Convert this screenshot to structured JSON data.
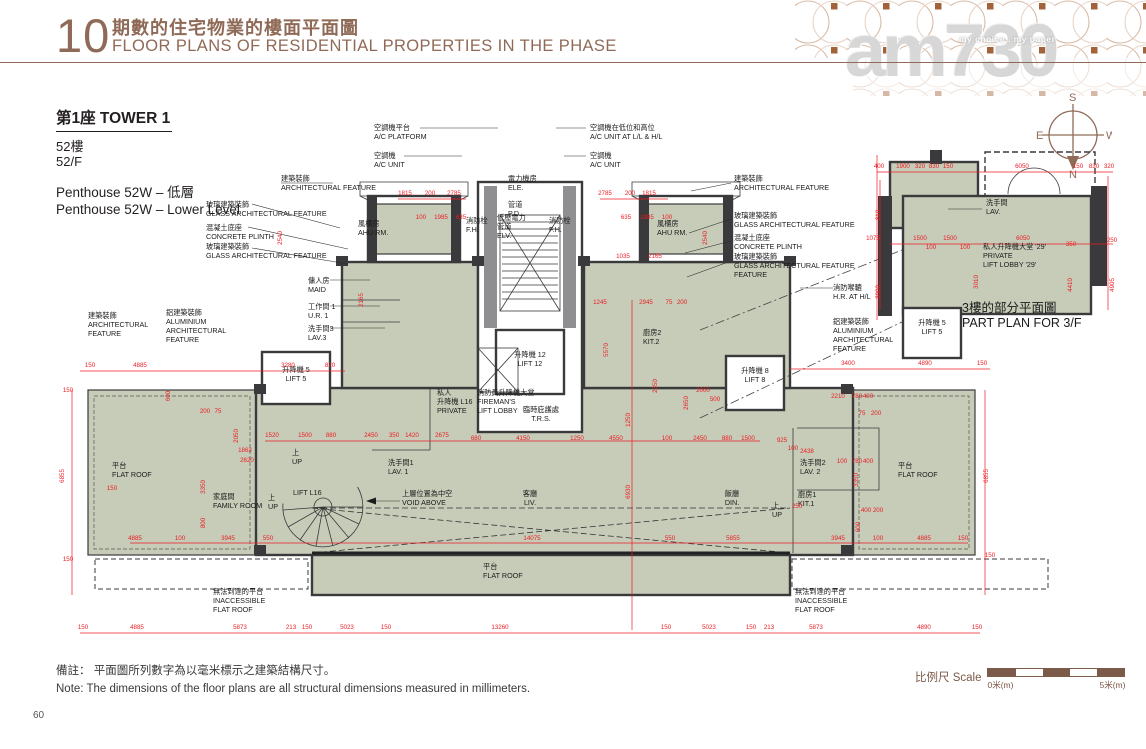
{
  "page": {
    "number": "60"
  },
  "header": {
    "section_number": "10",
    "title_zh": "期數的住宅物業的樓面平面圖",
    "title_en": "FLOOR PLANS OF RESIDENTIAL PROPERTIES IN THE PHASE"
  },
  "watermark": {
    "brand": "am730",
    "tagline": "my choice . my paper"
  },
  "tower": {
    "title": "第1座  TOWER 1",
    "floor_zh": "52樓",
    "floor_en": "52/F",
    "unit_zh": "Penthouse 52W – 低層",
    "unit_en": "Penthouse 52W – Lower Level"
  },
  "compass": {
    "n": "N",
    "s": "S",
    "e": "E",
    "w": "W"
  },
  "notes": {
    "zh": "備註： 平面圖所列數字為以毫米標示之建築結構尺寸。",
    "en": "Note:  The dimensions of the floor plans are all structural dimensions measured in millimeters."
  },
  "scale": {
    "label": "比例尺 Scale",
    "start": "0米(m)",
    "end": "5米(m)"
  },
  "plan": {
    "labels": [
      {
        "n": "ac-platform-label",
        "x": 374,
        "y": 130,
        "ls": [
          "空調機平台",
          "A/C PLATFORM"
        ]
      },
      {
        "n": "ac-unit-left-label",
        "x": 374,
        "y": 158,
        "ls": [
          "空調機",
          "A/C UNIT"
        ]
      },
      {
        "n": "ac-unit-llhl-label",
        "x": 590,
        "y": 130,
        "ls": [
          "空調機在低位和高位",
          "A/C UNIT  AT L/L & H/L"
        ]
      },
      {
        "n": "ac-unit-right-label",
        "x": 590,
        "y": 158,
        "ls": [
          "空調機",
          "A/C UNIT"
        ]
      },
      {
        "n": "ele-room-label",
        "x": 508,
        "y": 181,
        "ls": [
          "電力機房",
          "ELE."
        ]
      },
      {
        "n": "pipe-duct-label",
        "x": 508,
        "y": 207,
        "ls": [
          "管道",
          "P.D."
        ]
      },
      {
        "n": "fire-hydrant-left-label",
        "x": 466,
        "y": 223,
        "ls": [
          "消防栓",
          "F.H."
        ]
      },
      {
        "n": "elv-duct-label",
        "x": 497,
        "y": 220,
        "ls": [
          "低壓電力",
          "管道",
          "ELV."
        ]
      },
      {
        "n": "fire-hydrant-right-label",
        "x": 549,
        "y": 223,
        "ls": [
          "消防栓",
          "F.H."
        ]
      },
      {
        "n": "ahu-room-left-label",
        "x": 358,
        "y": 226,
        "ls": [
          "風櫃房",
          "AHU RM."
        ]
      },
      {
        "n": "ahu-room-right-label",
        "x": 657,
        "y": 226,
        "ls": [
          "風櫃房",
          "AHU RM."
        ]
      },
      {
        "n": "arch-feature-left-top-label",
        "x": 281,
        "y": 181,
        "ls": [
          "建築裝飾",
          "ARCHITECTURAL FEATURE"
        ]
      },
      {
        "n": "glass-feature-left-label",
        "x": 206,
        "y": 207,
        "ls": [
          "玻璃建築裝飾",
          "GLASS ARCHITECTURAL FEATURE"
        ]
      },
      {
        "n": "concrete-plinth-left-label",
        "x": 206,
        "y": 230,
        "ls": [
          "混凝土底座",
          "CONCRETE PLINTH"
        ]
      },
      {
        "n": "glass-feature-left2-label",
        "x": 206,
        "y": 249,
        "ls": [
          "玻璃建築裝飾",
          "GLASS ARCHITECTURAL FEATURE"
        ]
      },
      {
        "n": "arch-feature-right-top-label",
        "x": 734,
        "y": 181,
        "ls": [
          "建築裝飾",
          "ARCHITECTURAL FEATURE"
        ]
      },
      {
        "n": "glass-feature-right-label",
        "x": 734,
        "y": 218,
        "ls": [
          "玻璃建築裝飾",
          "GLASS ARCHITECTURAL FEATURE"
        ]
      },
      {
        "n": "concrete-plinth-right-label",
        "x": 734,
        "y": 240,
        "ls": [
          "混凝土底座",
          "CONCRETE PLINTH"
        ]
      },
      {
        "n": "glass-feature-right2-label",
        "x": 734,
        "y": 259,
        "ls": [
          "玻璃建築裝飾",
          "GLASS ARCHITECTURAL FEATURE",
          "FEATURE"
        ]
      },
      {
        "n": "maid-room-label",
        "x": 308,
        "y": 283,
        "ls": [
          "傭人房",
          "MAID"
        ]
      },
      {
        "n": "utility-room-1-label",
        "x": 308,
        "y": 309,
        "ls": [
          "工作間 1",
          "U.R. 1"
        ]
      },
      {
        "n": "lavatory-3-label",
        "x": 308,
        "y": 331,
        "ls": [
          "洗手間3",
          "LAV.3"
        ]
      },
      {
        "n": "arch-feature-left-mid-label",
        "x": 88,
        "y": 318,
        "ls": [
          "建築裝飾",
          "ARCHITECTURAL",
          "FEATURE"
        ]
      },
      {
        "n": "aluminium-feature-left-label",
        "x": 166,
        "y": 315,
        "ls": [
          "鋁建築裝飾",
          "ALUMINIUM",
          "ARCHITECTURAL",
          "FEATURE"
        ]
      },
      {
        "n": "hose-reel-label",
        "x": 833,
        "y": 290,
        "ls": [
          "消防喉轆",
          "H.R. AT H/L"
        ]
      },
      {
        "n": "aluminium-feature-right-label",
        "x": 833,
        "y": 324,
        "ls": [
          "鋁建築裝飾",
          "ALUMINIUM",
          "ARCHITECTURAL",
          "FEATURE"
        ]
      },
      {
        "n": "lift-5-label",
        "x": 296,
        "y": 372,
        "a": "m",
        "ls": [
          "升降機 5",
          "LIFT 5"
        ]
      },
      {
        "n": "lift-12-label",
        "x": 530,
        "y": 357,
        "a": "m",
        "ls": [
          "升降機 12",
          "LIFT 12"
        ]
      },
      {
        "n": "private-lift-l16-label",
        "x": 437,
        "y": 395,
        "ls": [
          "私人",
          "升降機 L16",
          "PRIVATE"
        ]
      },
      {
        "n": "firemans-lift-lobby-label",
        "x": 477,
        "y": 395,
        "ls": [
          "消防員升降機大堂",
          "FIREMAN'S",
          "LIFT LOBBY"
        ]
      },
      {
        "n": "trs-label",
        "x": 541,
        "y": 412,
        "a": "m",
        "ls": [
          "臨時庇護處",
          "T.R.S."
        ]
      },
      {
        "n": "kitchen-2-label",
        "x": 643,
        "y": 335,
        "ls": [
          "廚房2",
          "KIT.2"
        ]
      },
      {
        "n": "lift-8-label",
        "x": 755,
        "y": 373,
        "a": "m",
        "ls": [
          "升降機 8",
          "LIFT 8"
        ]
      },
      {
        "n": "lavatory-1-label",
        "x": 388,
        "y": 465,
        "ls": [
          "洗手間1",
          "LAV. 1"
        ]
      },
      {
        "n": "family-room-label",
        "x": 213,
        "y": 499,
        "ls": [
          "家庭間",
          "FAMILY ROOM"
        ]
      },
      {
        "n": "lift-l16-stair-label",
        "x": 293,
        "y": 495,
        "ls": [
          "LIFT L16"
        ]
      },
      {
        "n": "up-label-1",
        "x": 292,
        "y": 455,
        "ls": [
          "上",
          "UP"
        ]
      },
      {
        "n": "up-label-2",
        "x": 268,
        "y": 500,
        "ls": [
          "上",
          "UP"
        ]
      },
      {
        "n": "up-label-3",
        "x": 772,
        "y": 508,
        "ls": [
          "上",
          "UP"
        ]
      },
      {
        "n": "void-above-label",
        "x": 402,
        "y": 496,
        "ls": [
          "上層位置為中空",
          "VOID ABOVE"
        ]
      },
      {
        "n": "living-room-label",
        "x": 530,
        "y": 496,
        "a": "m",
        "ls": [
          "客廳",
          "LIV."
        ]
      },
      {
        "n": "dining-room-label",
        "x": 732,
        "y": 496,
        "a": "m",
        "ls": [
          "飯廳",
          "DIN."
        ]
      },
      {
        "n": "kitchen-1-label",
        "x": 798,
        "y": 497,
        "ls": [
          "廚房1",
          "KIT.1"
        ]
      },
      {
        "n": "lavatory-2-label",
        "x": 800,
        "y": 465,
        "ls": [
          "洗手間2",
          "LAV. 2"
        ]
      },
      {
        "n": "flat-roof-left-label",
        "x": 112,
        "y": 468,
        "ls": [
          "平台",
          "FLAT ROOF"
        ]
      },
      {
        "n": "flat-roof-right-label",
        "x": 898,
        "y": 468,
        "ls": [
          "平台",
          "FLAT ROOF"
        ]
      },
      {
        "n": "flat-roof-bottom-label",
        "x": 483,
        "y": 569,
        "ls": [
          "平台",
          "FLAT ROOF"
        ]
      },
      {
        "n": "inaccessible-flat-roof-left-label",
        "x": 213,
        "y": 594,
        "ls": [
          "無法到達的平台",
          "INACCESSIBLE",
          "FLAT ROOF"
        ]
      },
      {
        "n": "inaccessible-flat-roof-right-label",
        "x": 795,
        "y": 594,
        "ls": [
          "無法到達的平台",
          "INACCESSIBLE",
          "FLAT ROOF"
        ]
      },
      {
        "n": "part-plan-lav-label",
        "x": 986,
        "y": 205,
        "ls": [
          "洗手間",
          "LAV."
        ]
      },
      {
        "n": "part-plan-lift-lobby-label",
        "x": 983,
        "y": 249,
        "ls": [
          "私人升降機大堂 '29'",
          "PRIVATE",
          "LIFT LOBBY '29'"
        ]
      },
      {
        "n": "part-plan-lift-5-label",
        "x": 932,
        "y": 325,
        "a": "m",
        "ls": [
          "升降機 5",
          "LIFT 5"
        ]
      },
      {
        "n": "part-plan-title",
        "x": 962,
        "y": 312,
        "fs": 12.5,
        "lh": 15,
        "ls": [
          "3樓的部分平面圖",
          "PART PLAN FOR 3/F"
        ]
      }
    ],
    "dims": [
      [
        83,
        629,
        "150"
      ],
      [
        137,
        629,
        "4885"
      ],
      [
        240,
        629,
        "5873"
      ],
      [
        291,
        629,
        "213"
      ],
      [
        307,
        629,
        "150"
      ],
      [
        347,
        629,
        "5023"
      ],
      [
        386,
        629,
        "150"
      ],
      [
        500,
        629,
        "13260"
      ],
      [
        666,
        629,
        "150"
      ],
      [
        709,
        629,
        "5023"
      ],
      [
        751,
        629,
        "150"
      ],
      [
        769,
        629,
        "213"
      ],
      [
        816,
        629,
        "5873"
      ],
      [
        924,
        629,
        "4890"
      ],
      [
        977,
        629,
        "150"
      ],
      [
        135,
        540,
        "4885"
      ],
      [
        180,
        540,
        "100"
      ],
      [
        228,
        540,
        "3945"
      ],
      [
        268,
        540,
        "550"
      ],
      [
        532,
        540,
        "14075"
      ],
      [
        670,
        540,
        "550"
      ],
      [
        733,
        540,
        "5855"
      ],
      [
        838,
        540,
        "3945"
      ],
      [
        878,
        540,
        "100"
      ],
      [
        924,
        540,
        "4885"
      ],
      [
        963,
        540,
        "150"
      ],
      [
        272,
        437,
        "1520"
      ],
      [
        305,
        437,
        "1500"
      ],
      [
        331,
        437,
        "880"
      ],
      [
        371,
        437,
        "2450"
      ],
      [
        394,
        437,
        "350"
      ],
      [
        412,
        437,
        "1420"
      ],
      [
        442,
        437,
        "2675"
      ],
      [
        476,
        440,
        "680"
      ],
      [
        523,
        440,
        "4150"
      ],
      [
        577,
        440,
        "1250"
      ],
      [
        616,
        440,
        "4550"
      ],
      [
        667,
        440,
        "100"
      ],
      [
        700,
        440,
        "2450"
      ],
      [
        727,
        440,
        "880"
      ],
      [
        748,
        440,
        "1500"
      ],
      [
        405,
        195,
        "1815"
      ],
      [
        430,
        195,
        "200"
      ],
      [
        454,
        195,
        "2785"
      ],
      [
        605,
        195,
        "2785"
      ],
      [
        630,
        195,
        "200"
      ],
      [
        649,
        195,
        "1815"
      ],
      [
        421,
        219,
        "100"
      ],
      [
        441,
        219,
        "1985"
      ],
      [
        461,
        219,
        "635"
      ],
      [
        626,
        219,
        "635"
      ],
      [
        647,
        219,
        "1985"
      ],
      [
        667,
        219,
        "100"
      ],
      [
        90,
        367,
        "150"
      ],
      [
        140,
        367,
        "4885"
      ],
      [
        288,
        367,
        "3280"
      ],
      [
        330,
        367,
        "820"
      ],
      [
        848,
        365,
        "3400"
      ],
      [
        925,
        365,
        "4890"
      ],
      [
        982,
        365,
        "150"
      ],
      [
        68,
        392,
        "150"
      ],
      [
        64,
        476,
        "6855",
        1
      ],
      [
        68,
        561,
        "150"
      ],
      [
        988,
        476,
        "6855",
        1
      ],
      [
        990,
        557,
        "150"
      ],
      [
        630,
        492,
        "6930",
        1
      ],
      [
        608,
        350,
        "5570",
        1
      ],
      [
        657,
        386,
        "2350",
        1
      ],
      [
        688,
        403,
        "2650",
        1
      ],
      [
        630,
        420,
        "1250",
        1
      ],
      [
        623,
        258,
        "1035"
      ],
      [
        655,
        258,
        "2165"
      ],
      [
        600,
        304,
        "1245"
      ],
      [
        646,
        304,
        "2945"
      ],
      [
        669,
        304,
        "75"
      ],
      [
        682,
        304,
        "200"
      ],
      [
        363,
        300,
        "2165",
        1
      ],
      [
        282,
        238,
        "2540",
        1
      ],
      [
        707,
        238,
        "2540",
        1
      ],
      [
        703,
        392,
        "2000"
      ],
      [
        715,
        401,
        "500"
      ],
      [
        838,
        398,
        "2210"
      ],
      [
        857,
        398,
        "780"
      ],
      [
        868,
        398,
        "400"
      ],
      [
        862,
        415,
        "75"
      ],
      [
        876,
        415,
        "200"
      ],
      [
        170,
        396,
        "600",
        1
      ],
      [
        205,
        413,
        "200"
      ],
      [
        218,
        413,
        "75"
      ],
      [
        245,
        452,
        "1863"
      ],
      [
        247,
        462,
        "2620"
      ],
      [
        238,
        436,
        "2050",
        1
      ],
      [
        205,
        487,
        "3350",
        1
      ],
      [
        205,
        523,
        "800",
        1
      ],
      [
        112,
        490,
        "150"
      ],
      [
        782,
        442,
        "925"
      ],
      [
        793,
        450,
        "100"
      ],
      [
        807,
        453,
        "2438"
      ],
      [
        858,
        480,
        "3350",
        1
      ],
      [
        797,
        508,
        "250"
      ],
      [
        860,
        527,
        "600",
        1
      ],
      [
        866,
        512,
        "400"
      ],
      [
        878,
        512,
        "200"
      ],
      [
        842,
        463,
        "100"
      ],
      [
        857,
        463,
        "780"
      ],
      [
        868,
        463,
        "400"
      ],
      [
        879,
        168,
        "400"
      ],
      [
        903,
        168,
        "1900"
      ],
      [
        920,
        168,
        "320"
      ],
      [
        934,
        168,
        "830"
      ],
      [
        948,
        168,
        "150"
      ],
      [
        1022,
        168,
        "6050"
      ],
      [
        1078,
        168,
        "150"
      ],
      [
        1094,
        168,
        "830"
      ],
      [
        1109,
        168,
        "320"
      ],
      [
        873,
        240,
        "1075"
      ],
      [
        920,
        240,
        "1500"
      ],
      [
        950,
        240,
        "1500"
      ],
      [
        931,
        249,
        "100"
      ],
      [
        965,
        249,
        "100"
      ],
      [
        1023,
        240,
        "6050"
      ],
      [
        1071,
        246,
        "350"
      ],
      [
        1112,
        242,
        "250"
      ],
      [
        880,
        215,
        "810",
        1
      ],
      [
        880,
        292,
        "3900",
        1
      ],
      [
        978,
        282,
        "3010",
        1
      ],
      [
        1072,
        285,
        "4410",
        1
      ],
      [
        1114,
        285,
        "4905",
        1
      ]
    ]
  }
}
